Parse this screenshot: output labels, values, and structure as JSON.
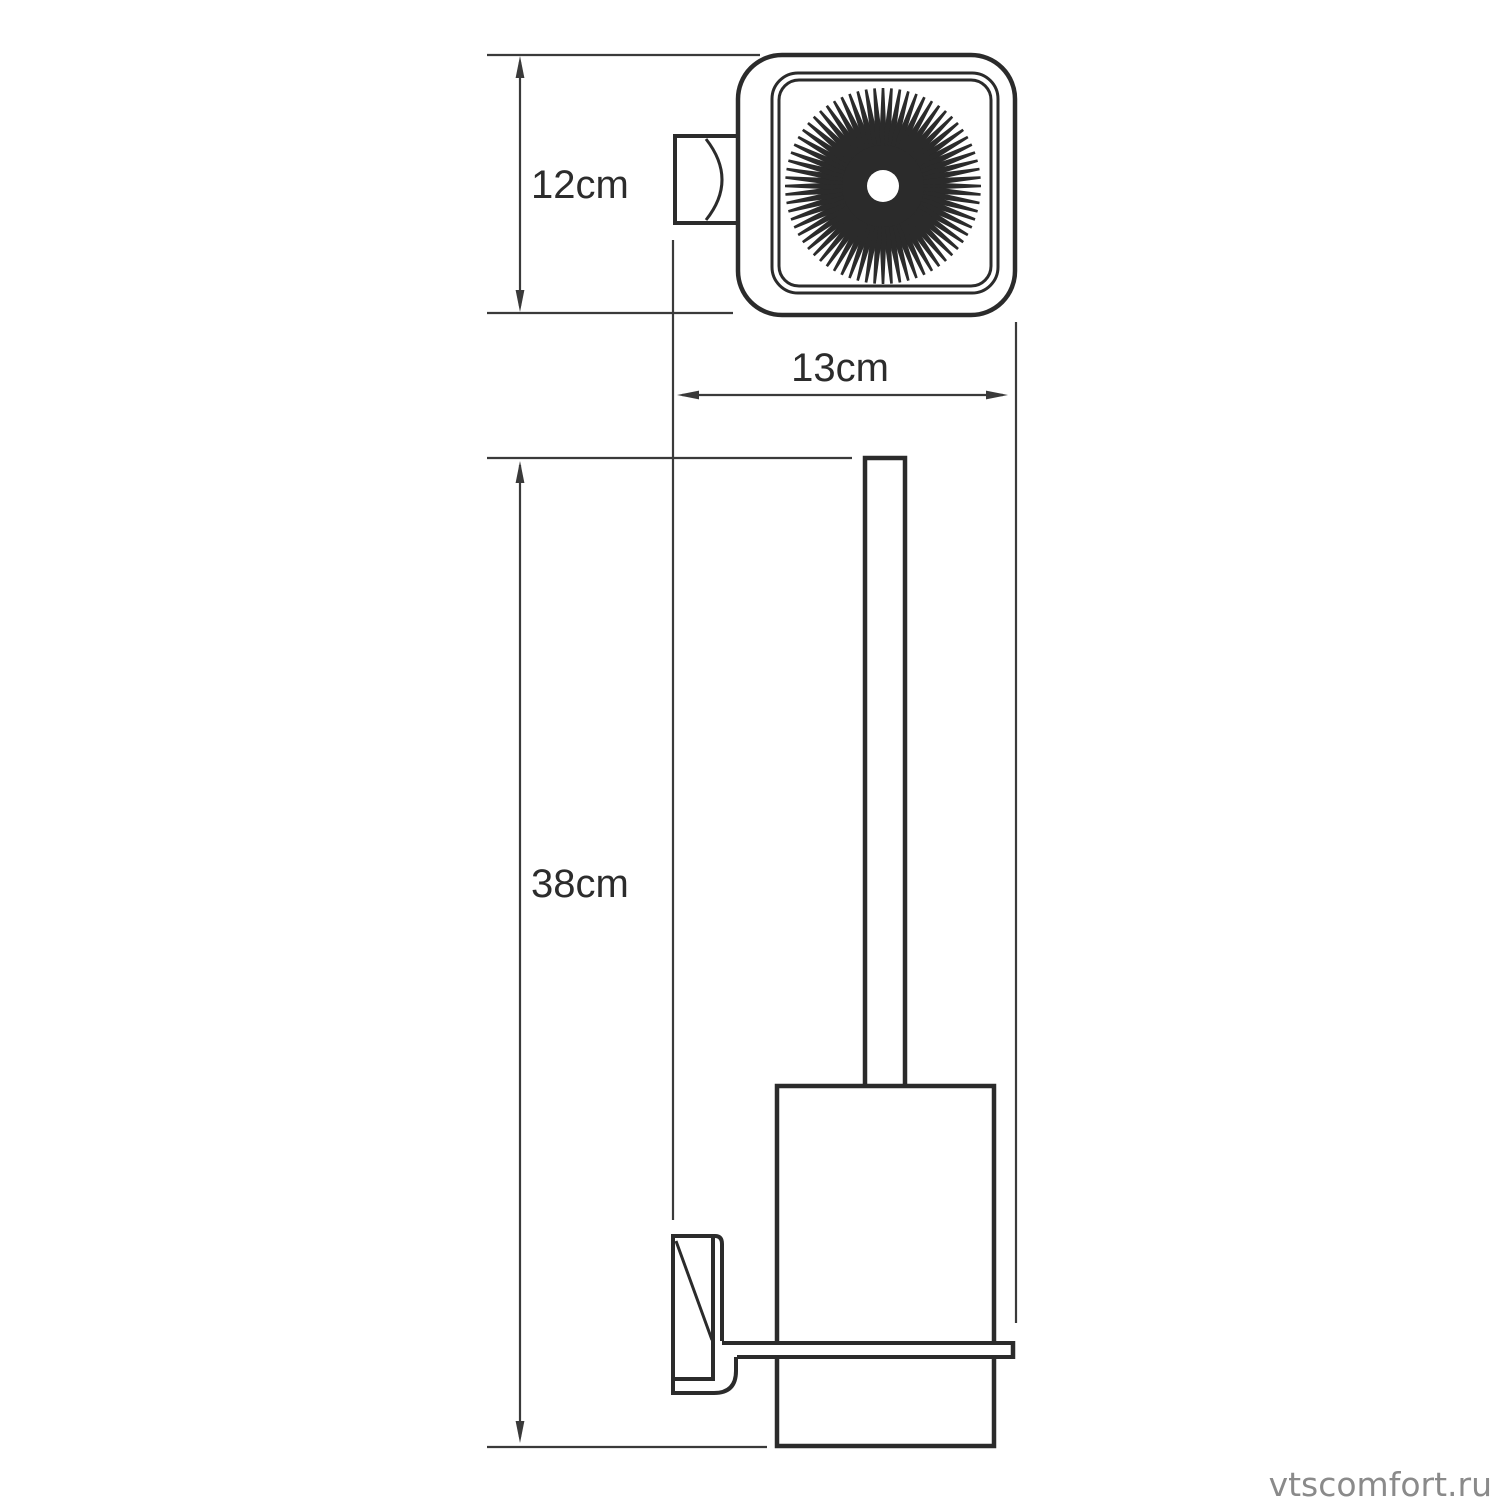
{
  "drawing": {
    "type": "technical-dimension-drawing",
    "views": {
      "top_view": "top view of wall-mounted brush holder",
      "front_view": "front view of wall-mounted toilet brush holder"
    }
  },
  "dimensions": {
    "d12": {
      "label": "12cm",
      "value": 12,
      "unit": "cm"
    },
    "d13": {
      "label": "13cm",
      "value": 13,
      "unit": "cm"
    },
    "d38": {
      "label": "38cm",
      "value": 38,
      "unit": "cm"
    }
  },
  "watermark": {
    "text": "vtscomfort.ru"
  },
  "icons": {
    "bristles": "starburst-icon"
  },
  "colors": {
    "outline": "#2b2b2b",
    "dimension": "#3a3a3a",
    "watermark": "#8a8a8a",
    "background": "#ffffff"
  }
}
